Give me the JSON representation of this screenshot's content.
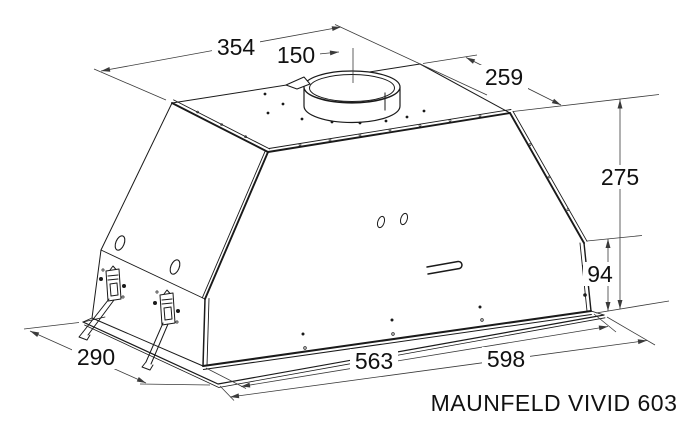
{
  "drawing": {
    "model_label": "MAUNFELD VIVID 603",
    "type_note": "technical dimensional line drawing of built-in kitchen hood",
    "dimensions": {
      "top_width": "354",
      "duct_diameter": "150",
      "top_depth": "259",
      "total_height": "275",
      "body_height": "94",
      "bottom_depth": "290",
      "body_width": "563",
      "total_width": "598"
    },
    "colors": {
      "line": "#1a1a1a",
      "dimension_line": "#3a3a3a",
      "text": "#111111",
      "background": "#ffffff"
    }
  }
}
